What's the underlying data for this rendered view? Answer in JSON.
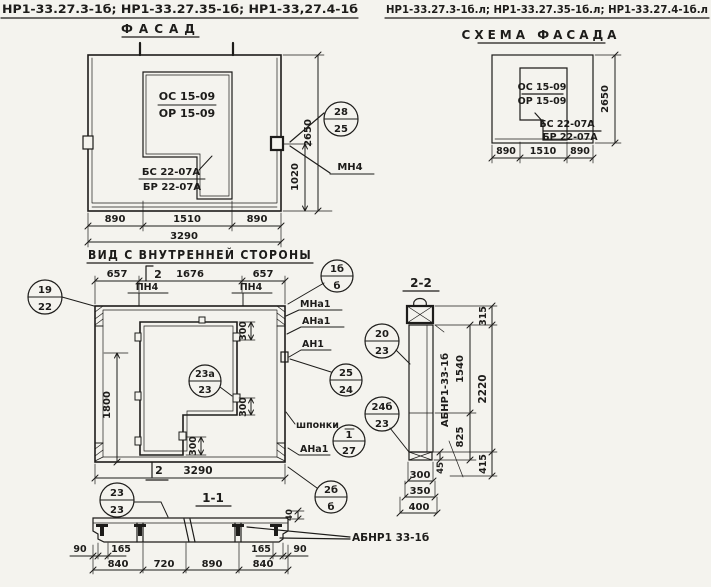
{
  "titles": {
    "left_codes": "НР1-33.27.3-1б; НР1-33.27.35-1б; НР1-33,27.4-1б",
    "facade": "ФАСАД",
    "right_codes": "НР1-33.27.3-1б.л; НР1-33.27.35-1б.л; НР1-33.27.4-1б.л",
    "schema": "СХЕМА ФАСАДА",
    "inner_view": "ВИД С ВНУТРЕННЕЙ СТОРОНЫ",
    "section2": "2-2",
    "section1": "1-1"
  },
  "facade": {
    "opening_mark_top": "ОС 15-09",
    "opening_mark_bottom": "ОР 15-09",
    "block_mark_top": "БС 22-07А",
    "block_mark_bottom": "БР 22-07А",
    "dim_left": "890",
    "dim_mid": "1510",
    "dim_right": "890",
    "dim_total": "3290",
    "dim_height": "2650",
    "dim_anchor": "1020",
    "ref_circle": {
      "top": "28",
      "bottom": "25"
    },
    "anchor_label": "МН4"
  },
  "schema": {
    "opening_mark_top": "ОС 15-09",
    "opening_mark_bottom": "ОР 15-09",
    "block_mark_top": "БС 22-07А",
    "block_mark_bottom": "БР 22-07А",
    "dim_left": "890",
    "dim_mid": "1510",
    "dim_right": "890",
    "dim_height": "2650"
  },
  "inner": {
    "dim_top_left": "657",
    "dim_top_mid": "1676",
    "dim_top_right": "657",
    "cut_mark_top": "2",
    "cut_mark_bottom": "2",
    "pin_label_left": "ПН4",
    "pin_label_right": "ПН4",
    "dim_side": "1800",
    "dim_total": "3290",
    "dim_key_top": "300",
    "dim_key_right": "300",
    "dim_key_bottom": "300",
    "keys_label": "шпонки",
    "label_mna1": "МНа1",
    "label_ana1_top": "АНа1",
    "label_an1": "АН1",
    "label_ana1_bottom": "АНа1",
    "circle_19": {
      "top": "19",
      "bottom": "22"
    },
    "circle_1b": {
      "top": "1б",
      "bottom": "б"
    },
    "circle_23a": {
      "top": "23а",
      "bottom": "23"
    },
    "circle_25": {
      "top": "25",
      "bottom": "24"
    },
    "circle_20": {
      "top": "20",
      "bottom": "23"
    },
    "circle_24b": {
      "top": "24б",
      "bottom": "23"
    },
    "circle_1": {
      "top": "1",
      "bottom": "27"
    },
    "circle_2b": {
      "top": "2б",
      "bottom": "б"
    }
  },
  "section2": {
    "dim_315": "315",
    "dim_1540": "1540",
    "dim_2220": "2220",
    "dim_825": "825",
    "dim_415": "415",
    "dim_45": "45",
    "dim_300": "300",
    "dim_350": "350",
    "dim_400": "400",
    "panel_label": "АБНР1-33-1б"
  },
  "section1": {
    "ref_circle": {
      "top": "23",
      "bottom": "23"
    },
    "dim_40": "40",
    "panel_label": "АБНР1 33-1б",
    "dim_90_left": "90",
    "dim_165_left": "165",
    "dim_165_right": "165",
    "dim_90_right": "90",
    "dim_840_left": "840",
    "dim_720": "720",
    "dim_890": "890",
    "dim_840_right": "840"
  }
}
